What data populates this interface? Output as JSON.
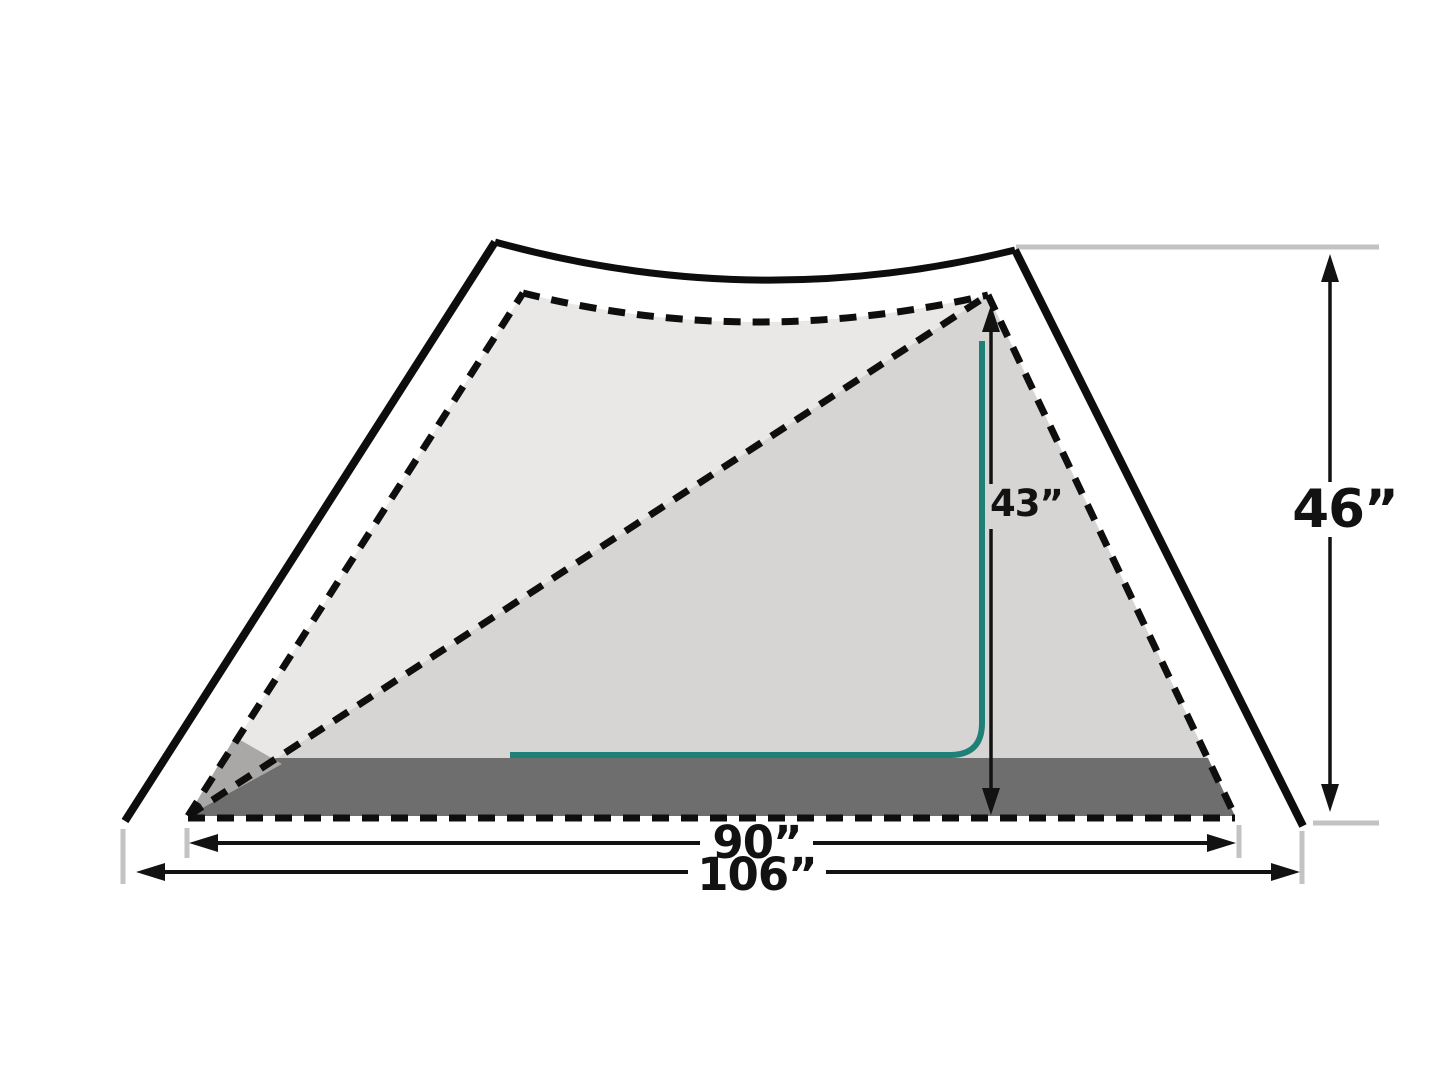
{
  "diagram": {
    "type": "tent-dimension-side-profile",
    "labels": {
      "interior_height": "43”",
      "peak_height": "46”",
      "interior_length": "90”",
      "overall_length": "106”"
    },
    "colors": {
      "outline_black": "#0d0d0d",
      "inner_back_fill": "#e9e8e7",
      "inner_front_fill": "#d6d5d3",
      "floor_fill": "#6f6e6e",
      "floor_end_fill": "#a9a8a6",
      "guide_gray": "#c4c3c2",
      "accent_teal": "#1e8077",
      "measure_black": "#121212"
    }
  }
}
